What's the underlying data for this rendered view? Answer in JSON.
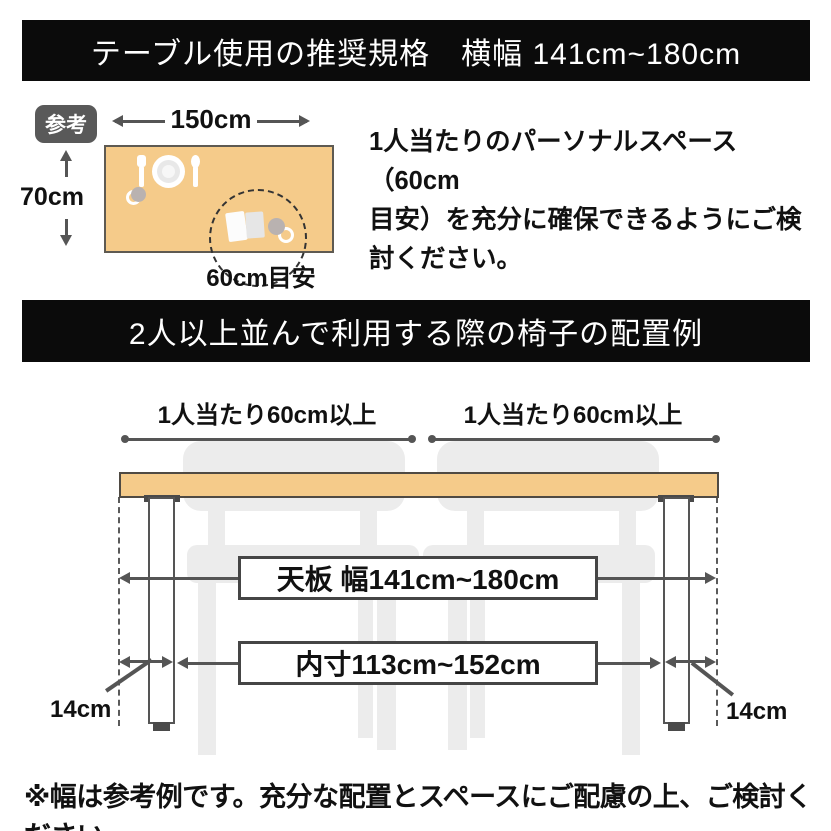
{
  "banner1": {
    "title": "テーブル使用の推奨規格　横幅 141cm~180cm"
  },
  "reference": {
    "badge_label": "参考",
    "width_label": "150cm",
    "depth_label": "70cm",
    "space_label": "60cm目安",
    "description": "1人当たりのパーソナルスペース（60cm\n目安）を充分に確保できるようにご検\n討ください。"
  },
  "banner2": {
    "title": "2人以上並んで利用する際の椅子の配置例"
  },
  "diagram": {
    "per_person_left": "1人当たり60cm以上",
    "per_person_right": "1人当たり60cm以上",
    "tabletop_width": "天板 幅141cm~180cm",
    "inner_width": "内寸113cm~152cm",
    "leg_offset_left": "14cm",
    "leg_offset_right": "14cm"
  },
  "footnote": "※幅は参考例です。充分な配置とスペースにご配慮の上、ご検討ください。",
  "colors": {
    "banner_bg": "#0b0b0b",
    "banner_text": "#ffffff",
    "table_fill": "#F5CB8A",
    "table_border": "#4f4a43",
    "line": "#555555",
    "chair_fill": "#ECECEC",
    "badge_bg": "#595959",
    "text": "#111111"
  }
}
